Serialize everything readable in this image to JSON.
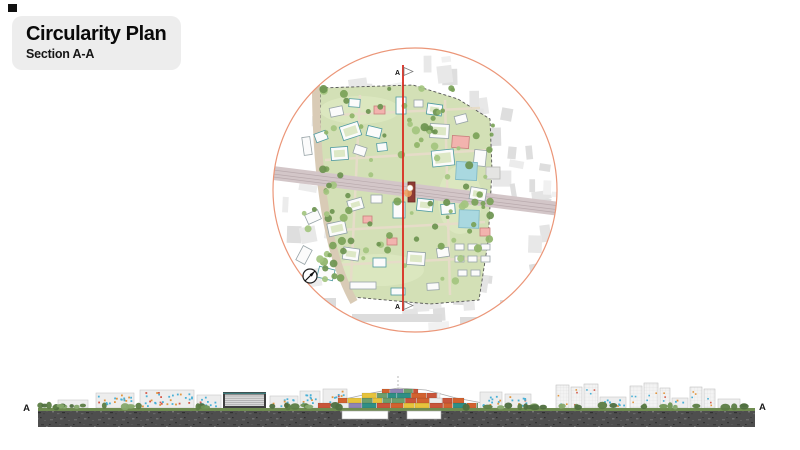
{
  "title_block": {
    "title": "Circularity Plan",
    "subtitle": "Section A-A",
    "bg": "#ededed"
  },
  "plan": {
    "section_line": {
      "label_top": "A",
      "label_bottom": "A",
      "color": "#d92b1f"
    },
    "circle_color": "#eb9678",
    "site_green": "#d3e0b6",
    "railway_color": "#d3c6c8",
    "road_color": "#d9cbb6",
    "pool_color": "#a9d8e0",
    "tree_greens": [
      "#8fb469",
      "#7aa258",
      "#a3c47f",
      "#6d9450"
    ],
    "context_grays": [
      "#ececec",
      "#e4e4e4",
      "#dedede",
      "#f1f1f1",
      "#e8e8e8"
    ],
    "buildings": [
      [
        330,
        107,
        13,
        9,
        -12,
        "w"
      ],
      [
        349,
        99,
        11,
        8,
        4,
        "t"
      ],
      [
        374,
        106,
        11,
        8,
        0,
        "p"
      ],
      [
        396,
        97,
        10,
        17,
        0,
        "t"
      ],
      [
        414,
        100,
        9,
        7,
        0,
        "w"
      ],
      [
        427,
        104,
        15,
        11,
        8,
        "c"
      ],
      [
        452,
        136,
        17,
        12,
        4,
        "p"
      ],
      [
        341,
        124,
        19,
        14,
        -18,
        "c"
      ],
      [
        367,
        127,
        14,
        10,
        14,
        "t"
      ],
      [
        303,
        137,
        8,
        18,
        -8,
        "w"
      ],
      [
        315,
        132,
        12,
        9,
        -20,
        "t"
      ],
      [
        331,
        147,
        17,
        13,
        -4,
        "c"
      ],
      [
        354,
        146,
        12,
        9,
        18,
        "w"
      ],
      [
        377,
        143,
        10,
        8,
        -6,
        "t"
      ],
      [
        430,
        124,
        19,
        14,
        3,
        "c"
      ],
      [
        455,
        115,
        12,
        8,
        -15,
        "w"
      ],
      [
        474,
        150,
        12,
        16,
        6,
        "w"
      ],
      [
        432,
        150,
        22,
        16,
        -6,
        "c"
      ],
      [
        470,
        188,
        16,
        12,
        10,
        "c"
      ],
      [
        456,
        162,
        21,
        18,
        3,
        "pool"
      ],
      [
        459,
        210,
        20,
        18,
        2,
        "pool"
      ],
      [
        486,
        167,
        14,
        12,
        0,
        "g"
      ],
      [
        348,
        199,
        15,
        11,
        -16,
        "c"
      ],
      [
        371,
        195,
        11,
        8,
        0,
        "w"
      ],
      [
        393,
        202,
        12,
        16,
        0,
        "t"
      ],
      [
        417,
        199,
        16,
        12,
        6,
        "c"
      ],
      [
        441,
        204,
        14,
        10,
        -4,
        "t"
      ],
      [
        408,
        182,
        7,
        20,
        0,
        "r"
      ],
      [
        363,
        216,
        9,
        7,
        0,
        "p"
      ],
      [
        387,
        238,
        10,
        7,
        0,
        "p"
      ],
      [
        328,
        222,
        18,
        13,
        -12,
        "c"
      ],
      [
        306,
        212,
        14,
        10,
        -24,
        "w"
      ],
      [
        343,
        248,
        16,
        12,
        8,
        "c"
      ],
      [
        373,
        258,
        13,
        9,
        0,
        "t"
      ],
      [
        407,
        252,
        18,
        13,
        4,
        "c"
      ],
      [
        437,
        248,
        12,
        9,
        -8,
        "w"
      ],
      [
        299,
        247,
        10,
        16,
        28,
        "w"
      ],
      [
        318,
        268,
        16,
        11,
        14,
        "t"
      ],
      [
        350,
        282,
        26,
        7,
        0,
        "w"
      ],
      [
        391,
        288,
        14,
        7,
        0,
        "t"
      ],
      [
        427,
        283,
        12,
        7,
        -3,
        "w"
      ],
      [
        455,
        244,
        9,
        6,
        0,
        "w"
      ],
      [
        468,
        244,
        9,
        6,
        0,
        "w"
      ],
      [
        481,
        244,
        9,
        6,
        0,
        "w"
      ],
      [
        455,
        256,
        9,
        6,
        0,
        "w"
      ],
      [
        468,
        256,
        9,
        6,
        0,
        "w"
      ],
      [
        481,
        256,
        9,
        6,
        0,
        "w"
      ],
      [
        458,
        270,
        9,
        6,
        0,
        "w"
      ],
      [
        471,
        270,
        9,
        6,
        0,
        "w"
      ],
      [
        480,
        228,
        10,
        8,
        0,
        "p"
      ]
    ],
    "context_slabs": [
      [
        352,
        314,
        90,
        8
      ],
      [
        460,
        317,
        72,
        7
      ],
      [
        296,
        298,
        40,
        9
      ],
      [
        500,
        300,
        46,
        8
      ]
    ],
    "tree_zones": [
      {
        "x": 322,
        "y": 88,
        "w": 158,
        "h": 44,
        "n": 26
      },
      {
        "x": 320,
        "y": 132,
        "w": 36,
        "h": 148,
        "n": 20
      },
      {
        "x": 442,
        "y": 115,
        "w": 52,
        "h": 128,
        "n": 22
      },
      {
        "x": 356,
        "y": 130,
        "w": 88,
        "h": 58,
        "n": 10
      },
      {
        "x": 350,
        "y": 196,
        "w": 128,
        "h": 98,
        "n": 20
      },
      {
        "x": 300,
        "y": 200,
        "w": 44,
        "h": 88,
        "n": 10
      }
    ],
    "compass": "north-arrow"
  },
  "section": {
    "label_left": "A",
    "label_right": "A",
    "ground_color": "#4e4e4e",
    "window_dot_colors": [
      "#49b0d6",
      "#49b0d6",
      "#49b0d6",
      "#49b0d6",
      "#e2953d",
      "#d45a4a"
    ],
    "container_colors": [
      "#d2622f",
      "#2f8f85",
      "#e6c33c",
      "#8f84b4",
      "#ededed",
      "#c8553a",
      "#6d9e6d"
    ],
    "ground": {
      "x": 38,
      "y": 411,
      "w": 717,
      "h": 16
    },
    "green_strip": {
      "x": 38,
      "y": 408,
      "w": 717,
      "h": 3
    },
    "cuts": [
      [
        342,
        411,
        46,
        8
      ],
      [
        407,
        411,
        34,
        8
      ]
    ],
    "buildings": [
      [
        58,
        400,
        30,
        8,
        "plain"
      ],
      [
        96,
        393,
        38,
        15,
        "dots"
      ],
      [
        140,
        390,
        54,
        18,
        "dots"
      ],
      [
        197,
        395,
        24,
        13,
        "dots"
      ],
      [
        223,
        392,
        43,
        16,
        "louver"
      ],
      [
        270,
        396,
        28,
        12,
        "dots"
      ],
      [
        300,
        391,
        20,
        17,
        "dots"
      ],
      [
        323,
        389,
        24,
        19,
        "dots"
      ],
      [
        480,
        392,
        22,
        16,
        "dots"
      ],
      [
        505,
        394,
        26,
        14,
        "dots"
      ],
      [
        556,
        385,
        13,
        23,
        "tower"
      ],
      [
        571,
        387,
        11,
        21,
        "tower"
      ],
      [
        584,
        384,
        14,
        24,
        "tower"
      ],
      [
        600,
        397,
        26,
        11,
        "dots"
      ],
      [
        630,
        386,
        12,
        22,
        "tower"
      ],
      [
        644,
        383,
        14,
        25,
        "tower"
      ],
      [
        660,
        388,
        10,
        20,
        "tower"
      ],
      [
        672,
        398,
        16,
        10,
        "dots"
      ],
      [
        690,
        387,
        12,
        21,
        "tower"
      ],
      [
        704,
        389,
        11,
        19,
        "tower"
      ],
      [
        718,
        399,
        22,
        9,
        "plain"
      ]
    ],
    "container_tiers": [
      {
        "y": 403,
        "h": 5,
        "x0": 318,
        "x1": 478
      },
      {
        "y": 398,
        "h": 5,
        "x0": 338,
        "x1": 464
      },
      {
        "y": 393,
        "h": 5,
        "x0": 362,
        "x1": 440
      },
      {
        "y": 389,
        "h": 4,
        "x0": 382,
        "x1": 418
      }
    ],
    "tree_zones": [
      {
        "x0": 40,
        "x1": 96,
        "n": 12
      },
      {
        "x0": 98,
        "x1": 140,
        "n": 4
      },
      {
        "x0": 196,
        "x1": 222,
        "n": 3
      },
      {
        "x0": 268,
        "x1": 300,
        "n": 4
      },
      {
        "x0": 300,
        "x1": 340,
        "n": 5
      },
      {
        "x0": 460,
        "x1": 556,
        "n": 10
      },
      {
        "x0": 556,
        "x1": 750,
        "n": 16
      }
    ],
    "hedge_greens": [
      "#4f6f3f",
      "#6f9454",
      "#86a86b",
      "#5c7d45"
    ]
  }
}
